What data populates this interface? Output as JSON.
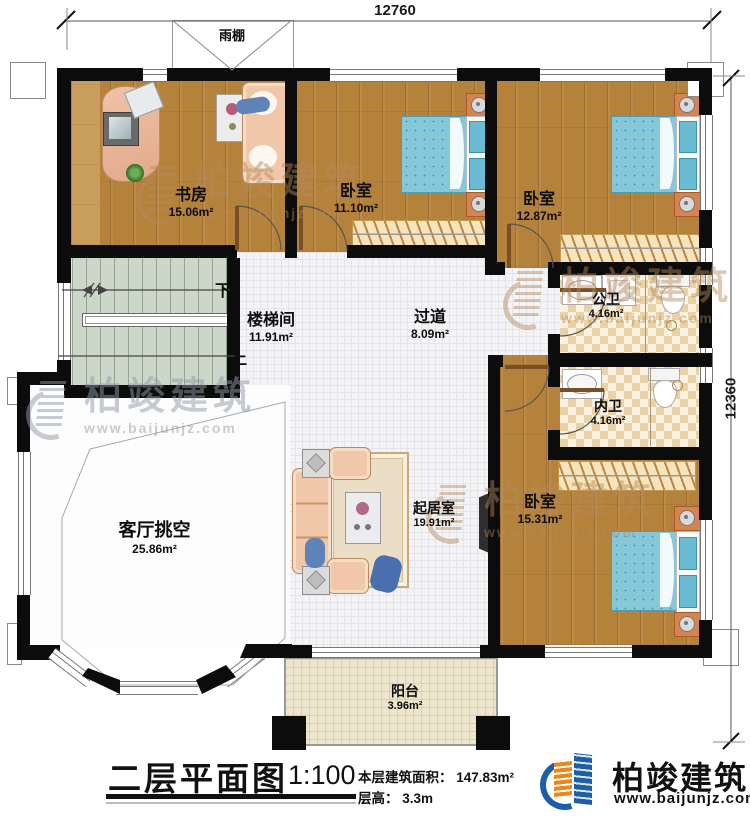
{
  "dimensions": {
    "top": "12760",
    "right": "12360"
  },
  "canopy": {
    "label": "雨棚"
  },
  "rooms": {
    "study": {
      "name": "书房",
      "area": "15.06m²"
    },
    "bedroom_top": {
      "name": "卧室",
      "area": "11.10m²"
    },
    "bedroom_right": {
      "name": "卧室",
      "area": "12.87m²"
    },
    "stairwell": {
      "name": "楼梯间",
      "area": "11.91m²"
    },
    "hallway": {
      "name": "过道",
      "area": "8.09m²"
    },
    "public_bath": {
      "name": "公卫",
      "area": "4.16m²"
    },
    "private_bath": {
      "name": "内卫",
      "area": "4.16m²"
    },
    "living_void": {
      "name": "客厅挑空",
      "area": "25.86m²"
    },
    "sitting_room": {
      "name": "起居室",
      "area": "19.91m²"
    },
    "bedroom_bottom": {
      "name": "卧室",
      "area": "15.31m²"
    },
    "balcony": {
      "name": "阳台",
      "area": "3.96m²"
    }
  },
  "stairs": {
    "down_label": "下",
    "up_label": "上"
  },
  "title_block": {
    "title": "二层平面图",
    "scale": "1:100",
    "area_text": "本层建筑面积： 147.83m²",
    "floor_height_text": "层高： 3.3m"
  },
  "brand": {
    "name": "柏竣建筑",
    "website": "www.baijunjz.com"
  },
  "watermark": {
    "text": "柏竣建筑",
    "website": "www.baijunjz.com"
  }
}
